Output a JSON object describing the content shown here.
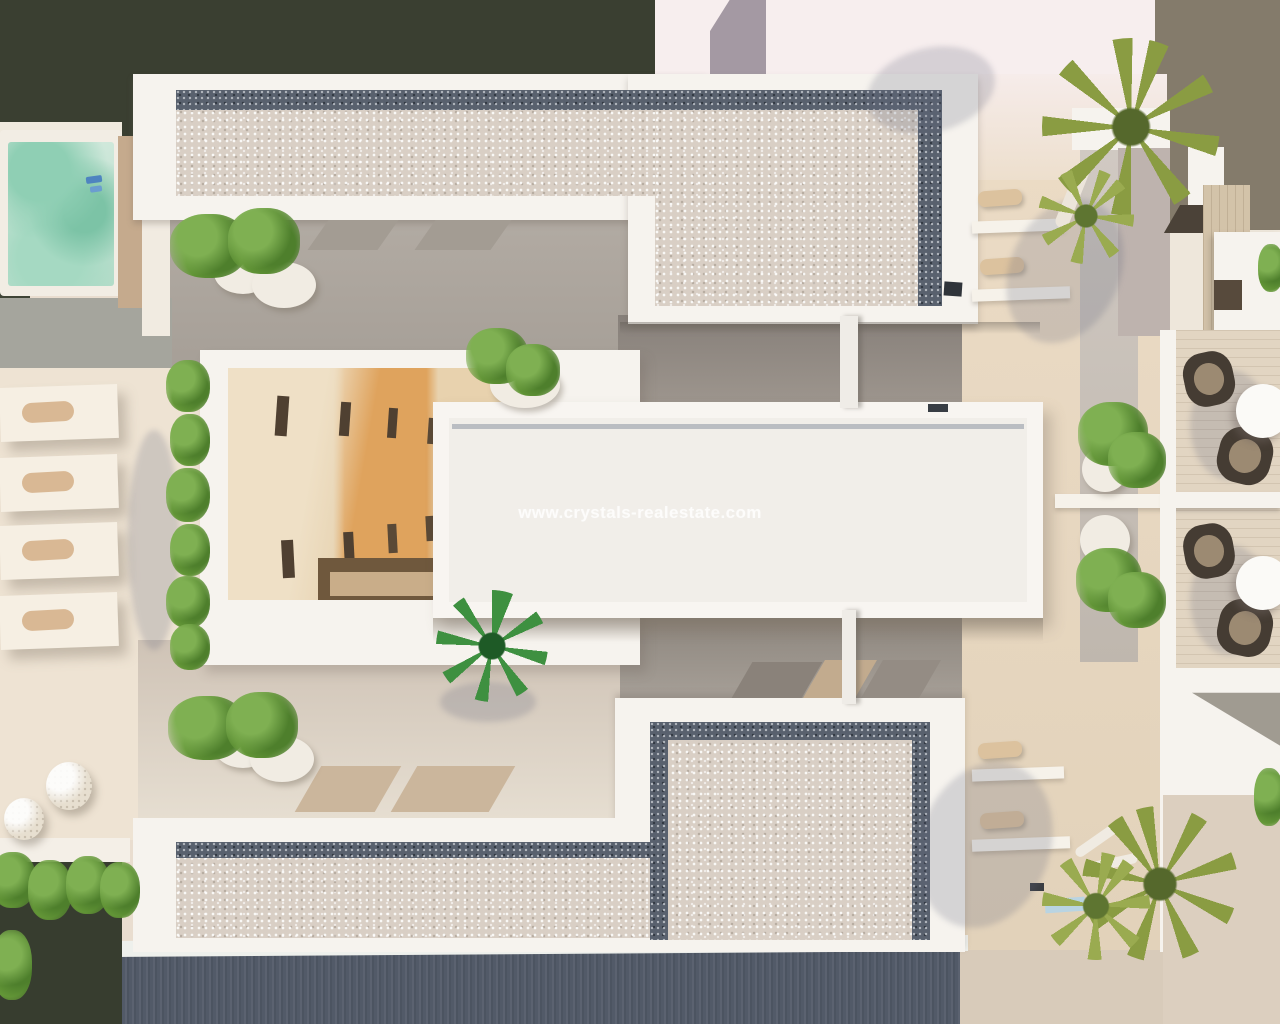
{
  "scene": {
    "type": "aerial-top-down-3d-architectural-render",
    "description": "Top view render of a modern white residential complex with gravel roof terraces, central atrium courtyard, jacuzzi, sun loungers, palm trees and balconies",
    "watermark": {
      "text": "www.crystals-realestate.com"
    },
    "palette": {
      "dark_foliage_background": "#3a3f31",
      "taupe_background": "#847b6b",
      "street_white": "#f7eeee",
      "wall_white": "#f6f3ee",
      "wall_shadow": "#e3dcd2",
      "gravel_light": "#d9cfc5",
      "gravel_dark_border": "#59616e",
      "courtyard_gray": "#a49d95",
      "terrace_beige": "#eee3d3",
      "walkway_beige": "#e6d6bd",
      "road_slate": "#525a68",
      "pavement_beige": "#d8cbba",
      "pool_water_green": "#a7d7c3",
      "deck_tan": "#c5aa8d",
      "atrium_orange_wall": "#dfa35d",
      "atrium_cream_wall": "#ecd9ba",
      "plant_green": "#5f8f3a",
      "palm_olive": "#8a9c42",
      "palm_vivid_green": "#3e9040"
    },
    "elements": [
      "jacuzzi-pool",
      "sun-loungers",
      "pebble-spheres",
      "hedge",
      "atrium-building",
      "roof-slab-watermarked",
      "top-roof-terrace-gravel",
      "bottom-roof-terrace-gravel",
      "right-walkway",
      "planter-pots",
      "balcony-tables-chairs",
      "palm-trees",
      "road",
      "pavement"
    ]
  }
}
